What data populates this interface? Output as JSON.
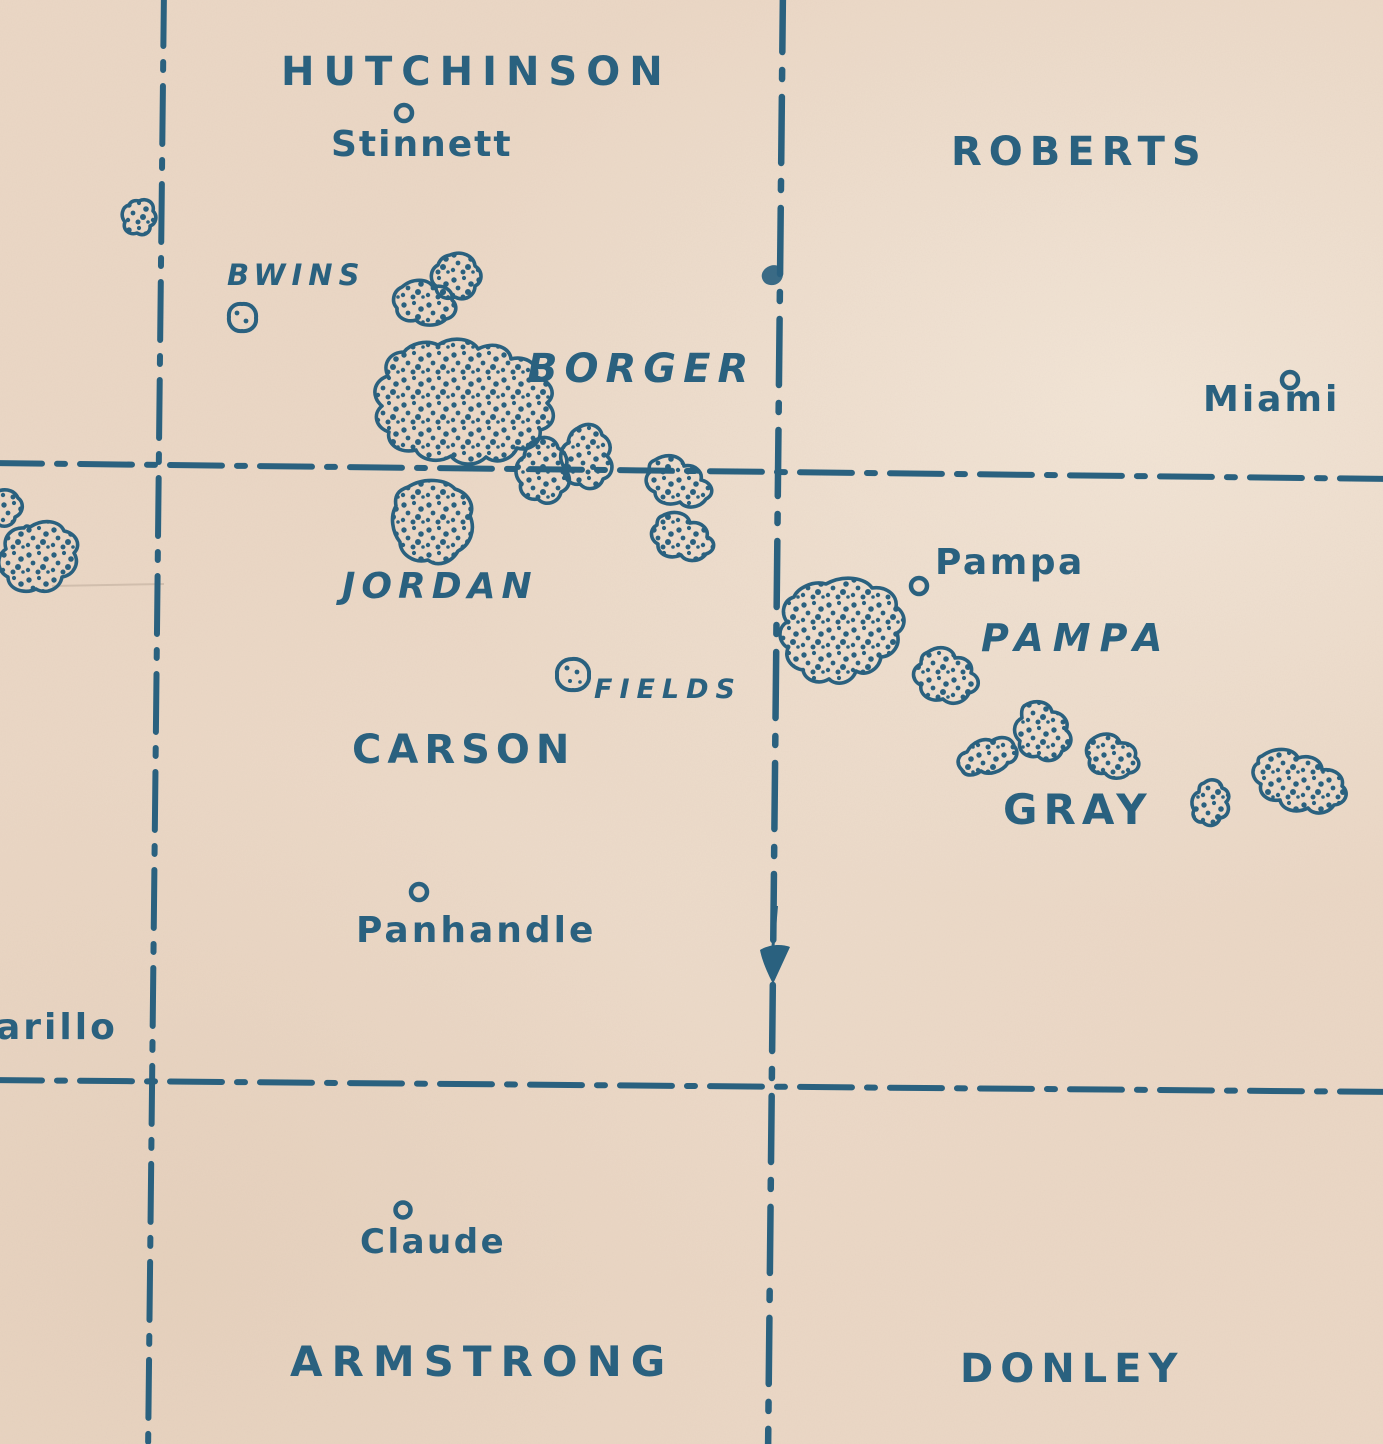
{
  "map": {
    "description": "Vintage blue-ink map of Texas Panhandle counties with stippled oil-field outlines",
    "ink_color": "#2a617f",
    "paper_color": "#ebd8c6"
  },
  "counties": [
    {
      "name": "HUTCHINSON"
    },
    {
      "name": "ROBERTS"
    },
    {
      "name": "CARSON"
    },
    {
      "name": "GRAY"
    },
    {
      "name": "ARMSTRONG"
    },
    {
      "name": "DONLEY"
    }
  ],
  "oil_fields": [
    {
      "name": "BWINS"
    },
    {
      "name": "BORGER"
    },
    {
      "name": "JORDAN"
    },
    {
      "name": "FIELDS"
    },
    {
      "name": "PAMPA"
    }
  ],
  "towns": [
    {
      "name": "Stinnett"
    },
    {
      "name": "Miami"
    },
    {
      "name": "Pampa"
    },
    {
      "name": "Panhandle"
    },
    {
      "name": "arillo"
    },
    {
      "name": "Claude"
    }
  ]
}
